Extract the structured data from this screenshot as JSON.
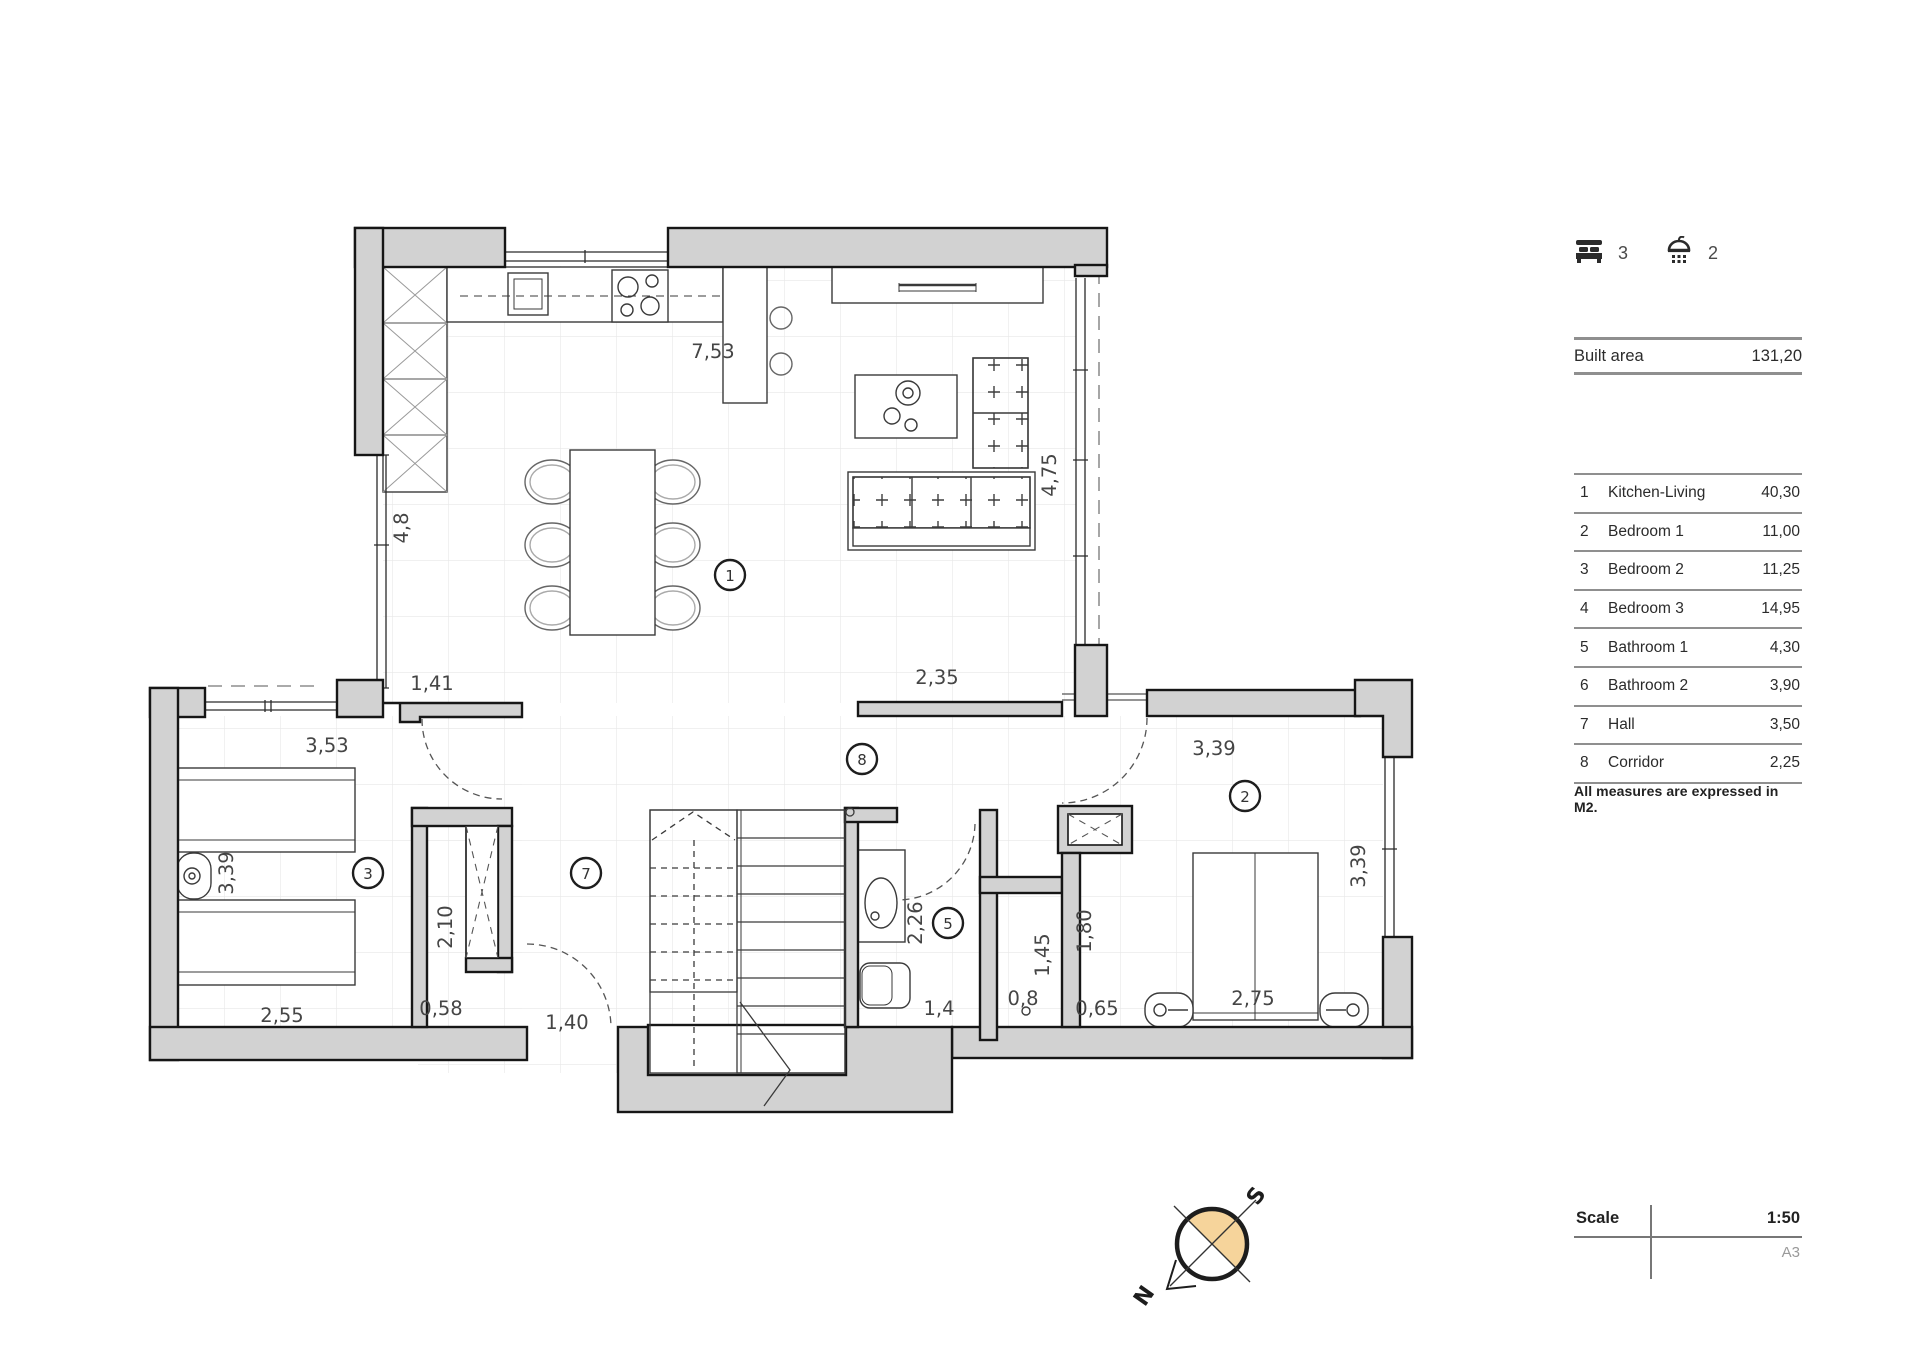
{
  "sidebar": {
    "stats": {
      "bedrooms": "3",
      "bathrooms": "2"
    },
    "built_area": {
      "label": "Built area",
      "value": "131,20"
    },
    "rooms": [
      {
        "num": "1",
        "name": "Kitchen-Living",
        "area": "40,30"
      },
      {
        "num": "2",
        "name": "Bedroom 1",
        "area": "11,00"
      },
      {
        "num": "3",
        "name": "Bedroom 2",
        "area": "11,25"
      },
      {
        "num": "4",
        "name": "Bedroom 3",
        "area": "14,95"
      },
      {
        "num": "5",
        "name": "Bathroom 1",
        "area": "4,30"
      },
      {
        "num": "6",
        "name": "Bathroom 2",
        "area": "3,90"
      },
      {
        "num": "7",
        "name": "Hall",
        "area": "3,50"
      },
      {
        "num": "8",
        "name": "Corridor",
        "area": "2,25"
      }
    ],
    "note": "All measures are expressed in M2.",
    "scale": {
      "label": "Scale",
      "value": "1:50",
      "paper": "A3"
    }
  },
  "compass": {
    "north": "N",
    "south": "S"
  },
  "plan": {
    "colors": {
      "wall": "#d2d2d2",
      "accent": "#f6d49b",
      "line": "#8f8f8f"
    },
    "dims": [
      {
        "t": "7,53"
      },
      {
        "t": "4,8"
      },
      {
        "t": "4,75"
      },
      {
        "t": "1,41"
      },
      {
        "t": "2,35"
      },
      {
        "t": "3,53"
      },
      {
        "t": "3,39"
      },
      {
        "t": "3,39"
      },
      {
        "t": "3,39"
      },
      {
        "t": "2,10"
      },
      {
        "t": "0,58"
      },
      {
        "t": "2,55"
      },
      {
        "t": "1,40"
      },
      {
        "t": "2,26"
      },
      {
        "t": "1,45"
      },
      {
        "t": "1,80"
      },
      {
        "t": "0,8"
      },
      {
        "t": "0,65"
      },
      {
        "t": "2,75"
      },
      {
        "t": "1,4"
      }
    ],
    "markers": [
      {
        "n": "1"
      },
      {
        "n": "2"
      },
      {
        "n": "3"
      },
      {
        "n": "5"
      },
      {
        "n": "7"
      },
      {
        "n": "8"
      }
    ]
  }
}
